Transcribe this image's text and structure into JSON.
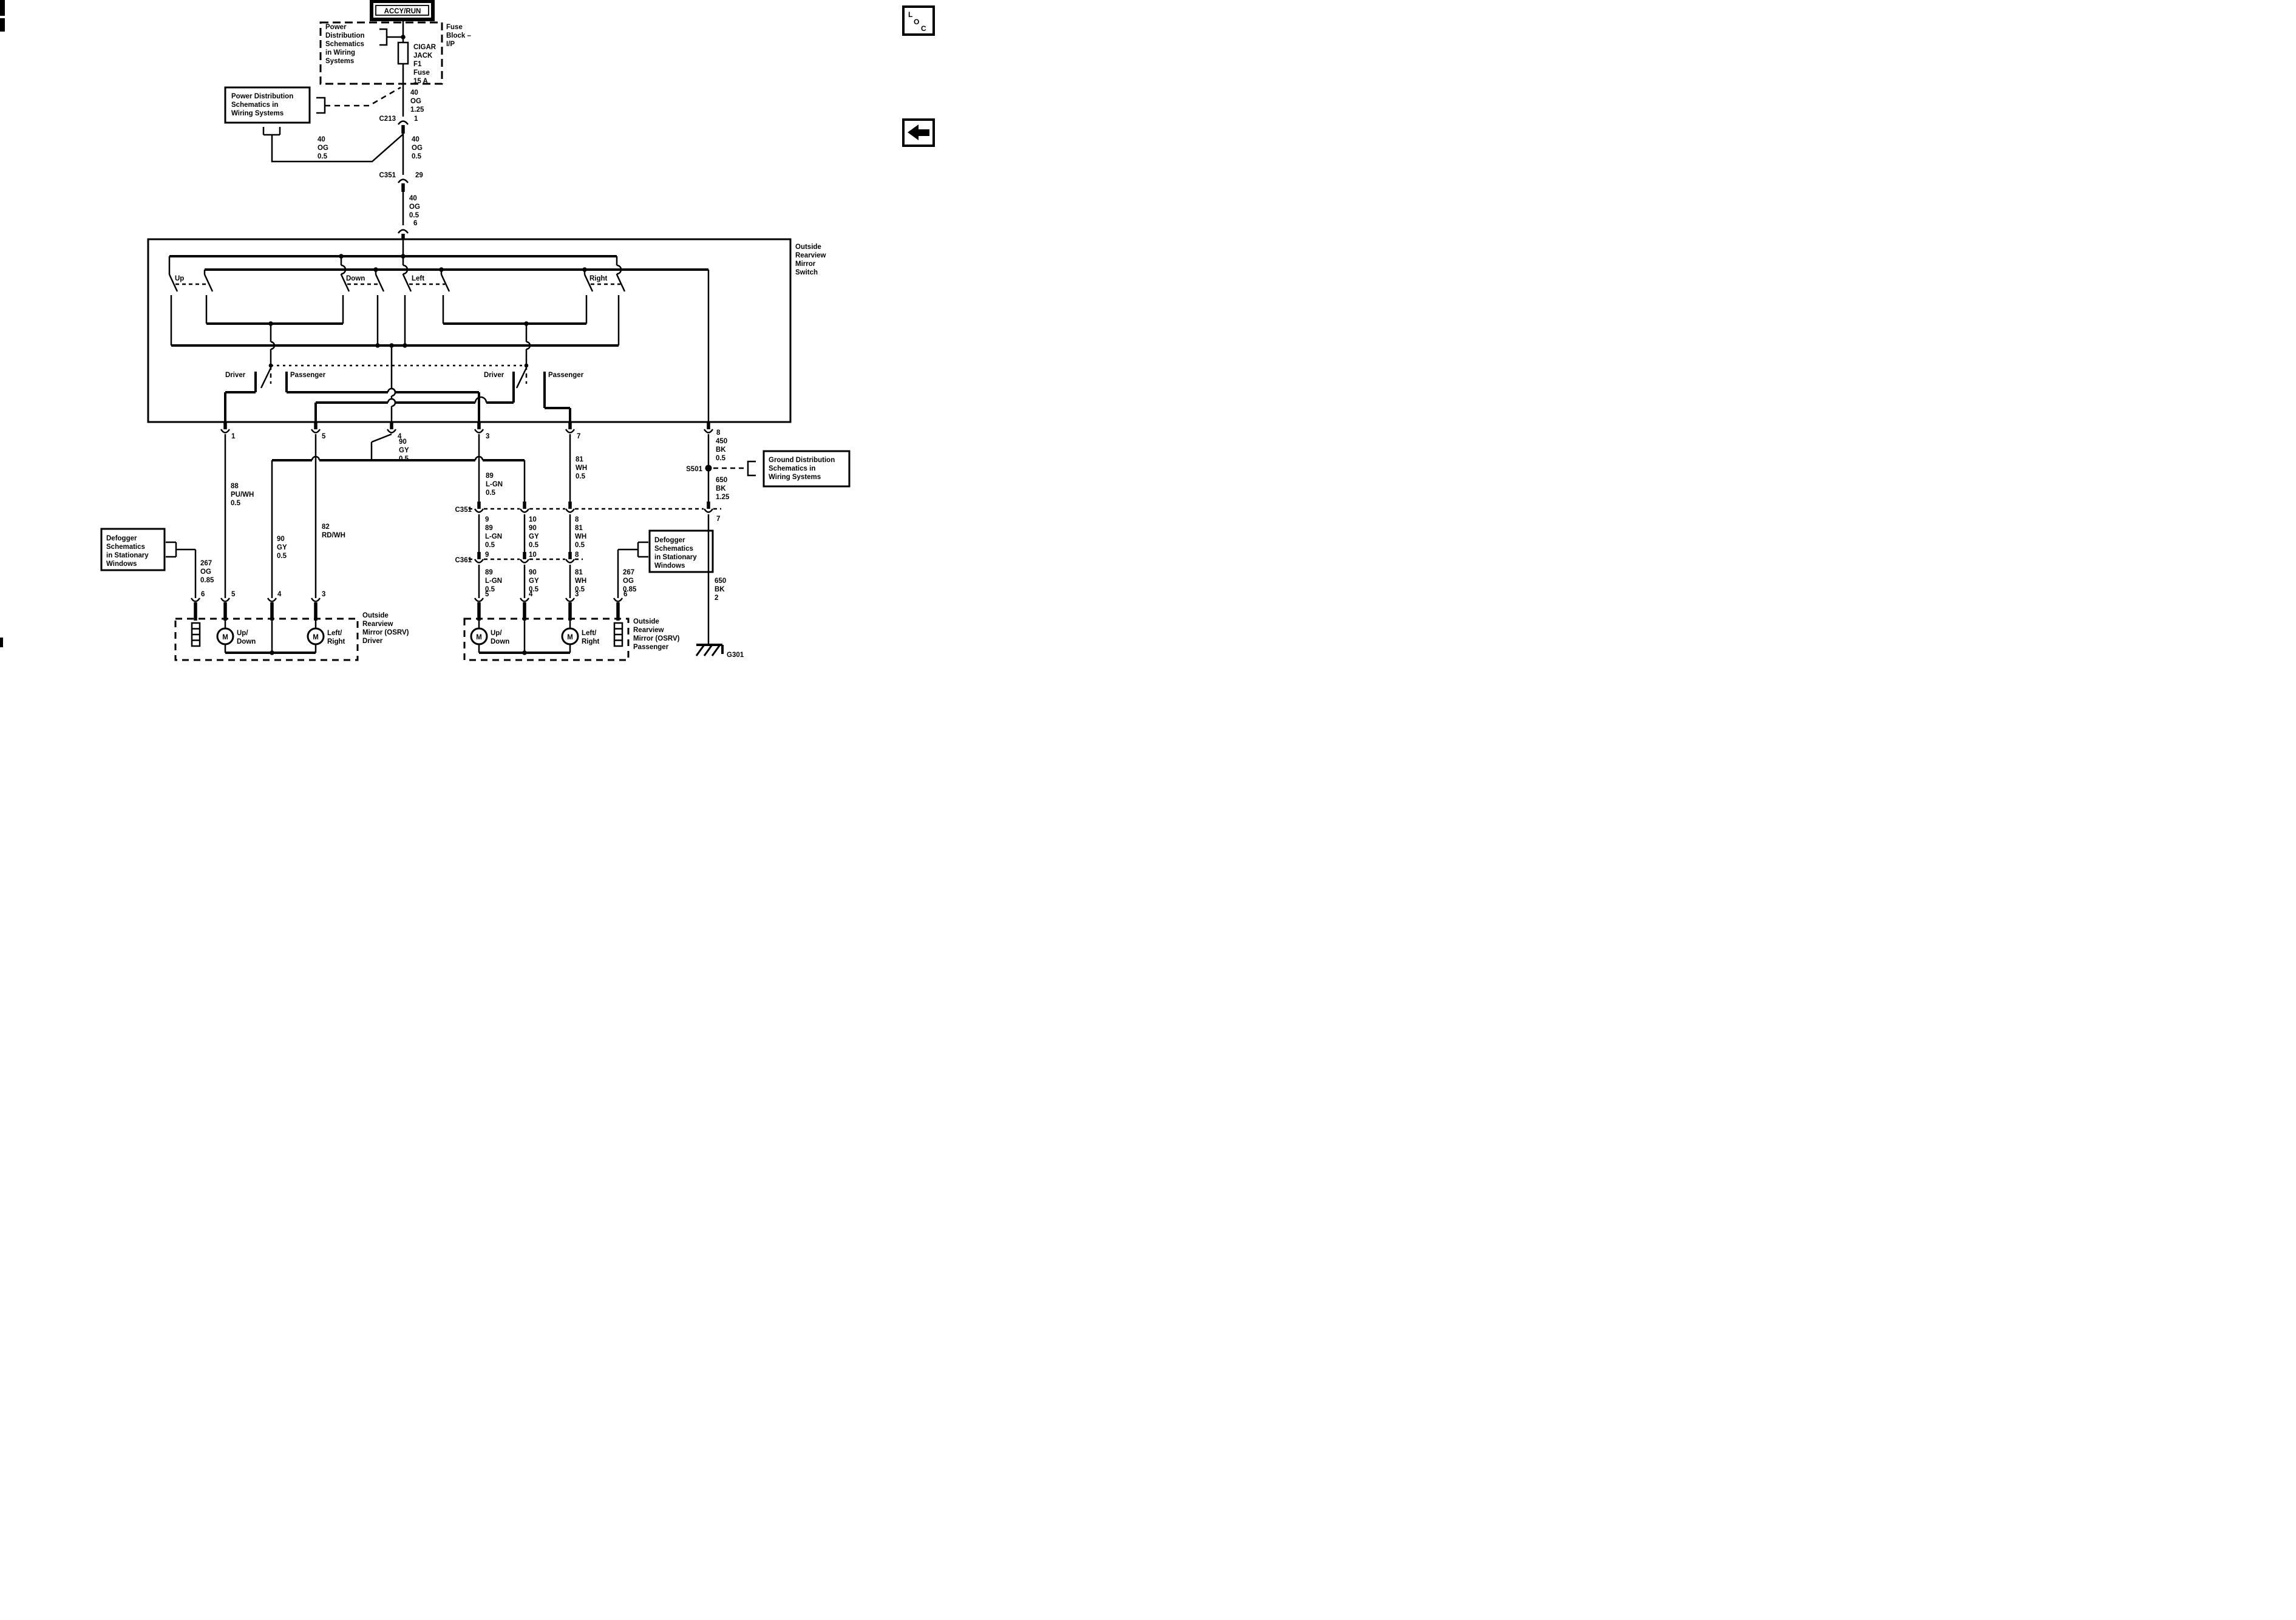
{
  "header": {
    "accy_run": "ACCY/RUN"
  },
  "nav": {
    "loc_letters": [
      "L",
      "O",
      "C"
    ]
  },
  "fuse_block": {
    "label": [
      "Fuse",
      "Block –",
      "I/P"
    ],
    "power_dist": [
      "Power",
      "Distribution",
      "Schematics",
      "in Wiring",
      "Systems"
    ],
    "fuse_name": [
      "CIGAR",
      "JACK",
      "F1",
      "Fuse",
      "15 A"
    ]
  },
  "power_dist_box": [
    "Power Distribution",
    "Schematics in",
    "Wiring Systems"
  ],
  "ground_box": [
    "Ground Distribution",
    "Schematics in",
    "Wiring Systems"
  ],
  "defogger_box": [
    "Defogger",
    "Schematics",
    "in Stationary",
    "Windows"
  ],
  "connectors": {
    "c213": "C213",
    "c213_pin": "1",
    "c351_top": "C351",
    "c351_top_pin": "29",
    "pin6_top": "6",
    "c351": "C351",
    "c361": "C361",
    "c351_pin7": "7"
  },
  "wires": {
    "og125": [
      "40",
      "OG",
      "1.25"
    ],
    "og05": [
      "40",
      "OG",
      "0.5"
    ],
    "pu88": [
      "88",
      "PU/WH",
      "0.5"
    ],
    "gy90": [
      "90",
      "GY",
      "0.5"
    ],
    "rd82": [
      "82",
      "RD/WH"
    ],
    "lgn89": [
      "89",
      "L-GN",
      "0.5"
    ],
    "wh81": [
      "81",
      "WH",
      "0.5"
    ],
    "bk450": [
      "450",
      "BK",
      "0.5"
    ],
    "bk650": [
      "650",
      "BK",
      "1.25"
    ],
    "bk650b": [
      "650",
      "BK",
      "2"
    ],
    "og267": [
      "267",
      "OG",
      "0.85"
    ]
  },
  "switch": {
    "title": [
      "Outside",
      "Rearview",
      "Mirror",
      "Switch"
    ],
    "up": "Up",
    "down": "Down",
    "left": "Left",
    "right": "Right",
    "driver": "Driver",
    "passenger": "Passenger",
    "pins": [
      "1",
      "5",
      "4",
      "3",
      "7",
      "8"
    ]
  },
  "row_pins": {
    "p9": "9",
    "p10": "10",
    "p8": "8",
    "p5": "5",
    "p4": "4",
    "p3": "3",
    "p6": "6"
  },
  "splice": "S501",
  "ground": "G301",
  "osrv_driver": [
    "Outside",
    "Rearview",
    "Mirror (OSRV)",
    "Driver"
  ],
  "osrv_passenger": [
    "Outside",
    "Rearview",
    "Mirror (OSRV)",
    "Passenger"
  ],
  "motor": {
    "m": "M",
    "updown": [
      "Up/",
      "Down"
    ],
    "leftright": [
      "Left/",
      "Right"
    ]
  }
}
